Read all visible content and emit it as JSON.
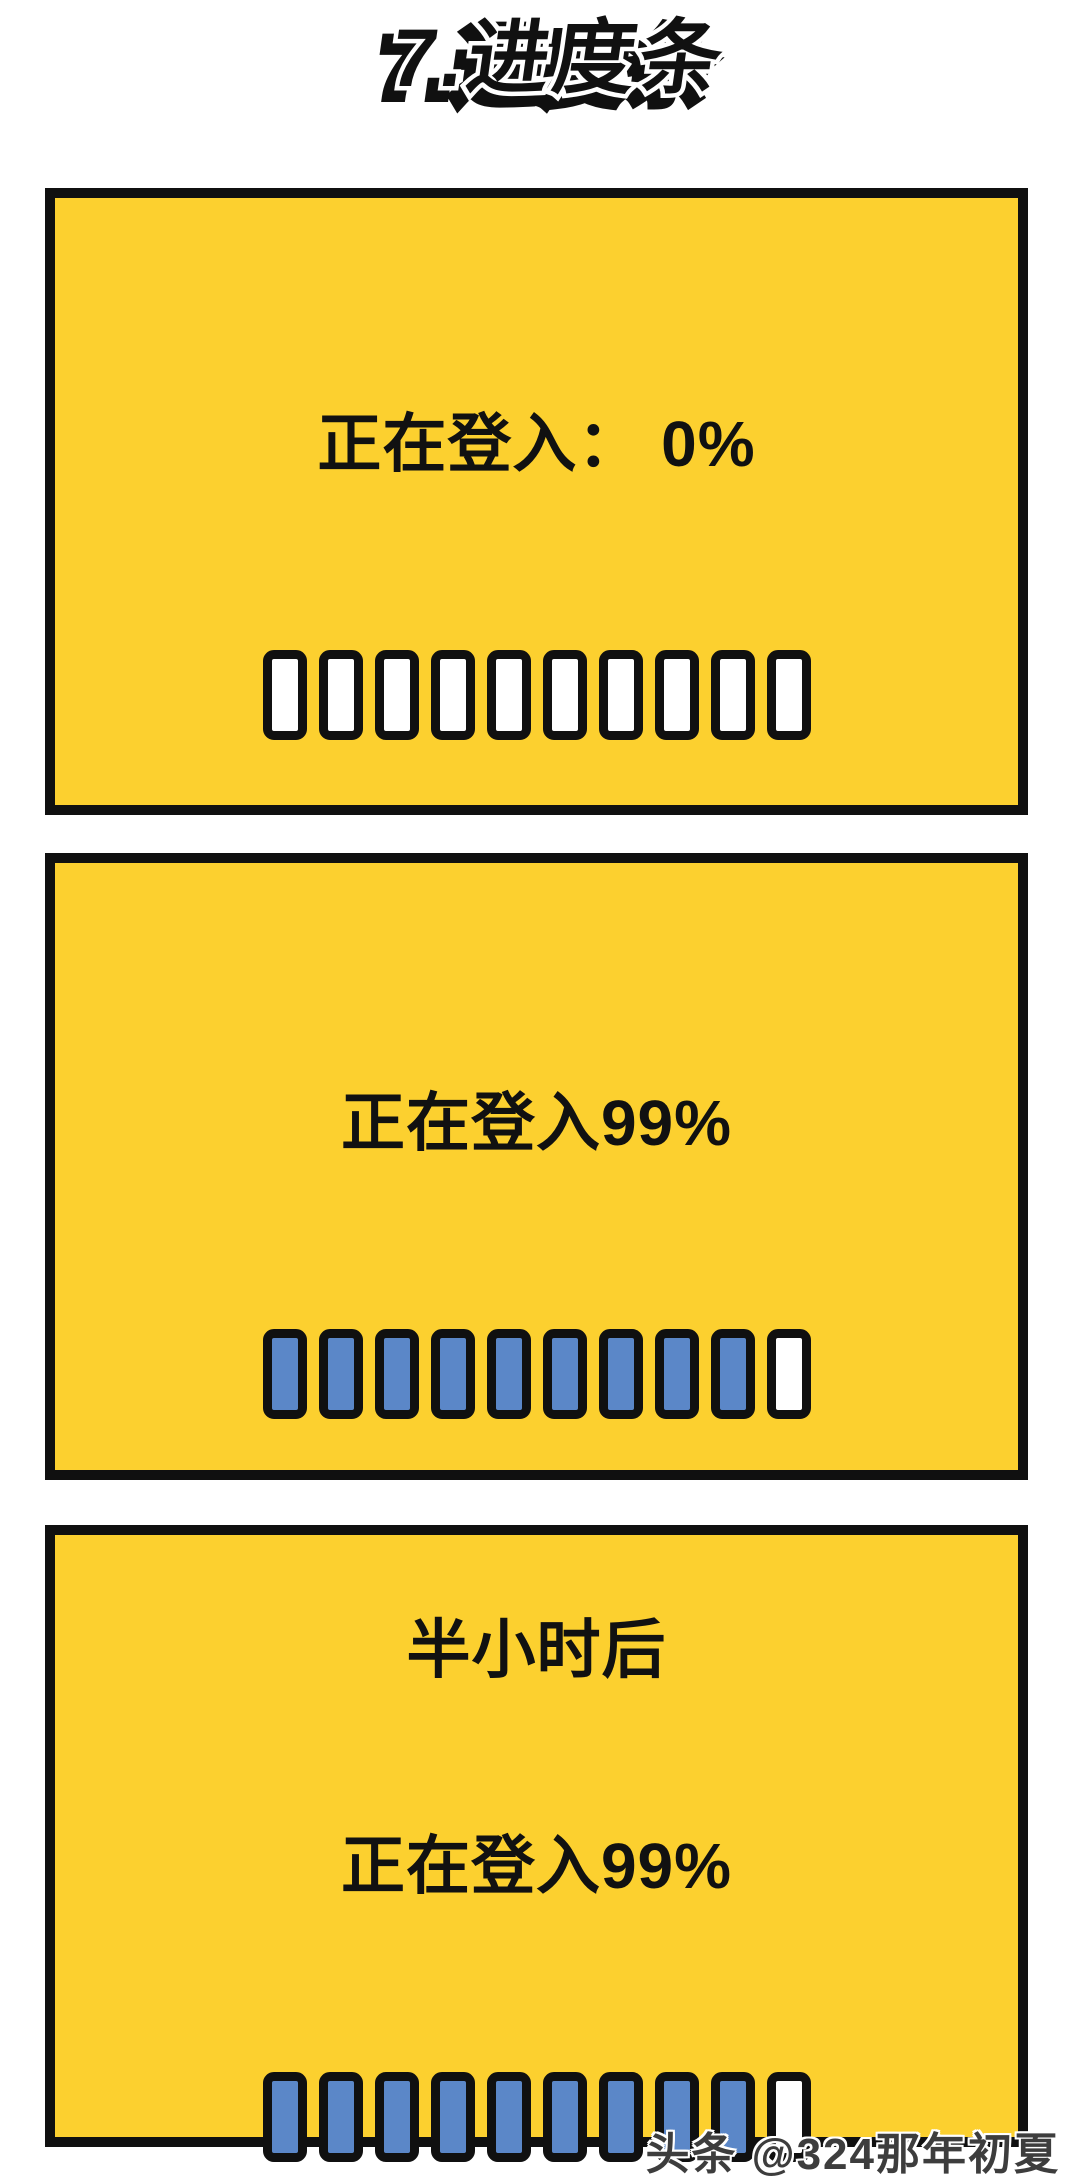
{
  "title": "7.进度条",
  "panels": [
    {
      "name": "login-0-percent",
      "lines": [
        "正在登入： 0%"
      ],
      "segments": {
        "total": 10,
        "filled": 0
      }
    },
    {
      "name": "login-99-percent",
      "lines": [
        "正在登入99%"
      ],
      "segments": {
        "total": 10,
        "filled": 9
      }
    },
    {
      "name": "half-hour-later-login-99-percent",
      "lines": [
        "半小时后",
        "正在登入99%"
      ],
      "segments": {
        "total": 10,
        "filled": 9
      }
    }
  ],
  "watermark": "头条 @324那年初夏",
  "colors": {
    "panel_bg": "#FCD02F",
    "segment_fill": "#5B87C8",
    "segment_empty": "#FFFFFF",
    "outline": "#101010",
    "text": "#111111",
    "watermark_text": "#3D3D3D"
  }
}
